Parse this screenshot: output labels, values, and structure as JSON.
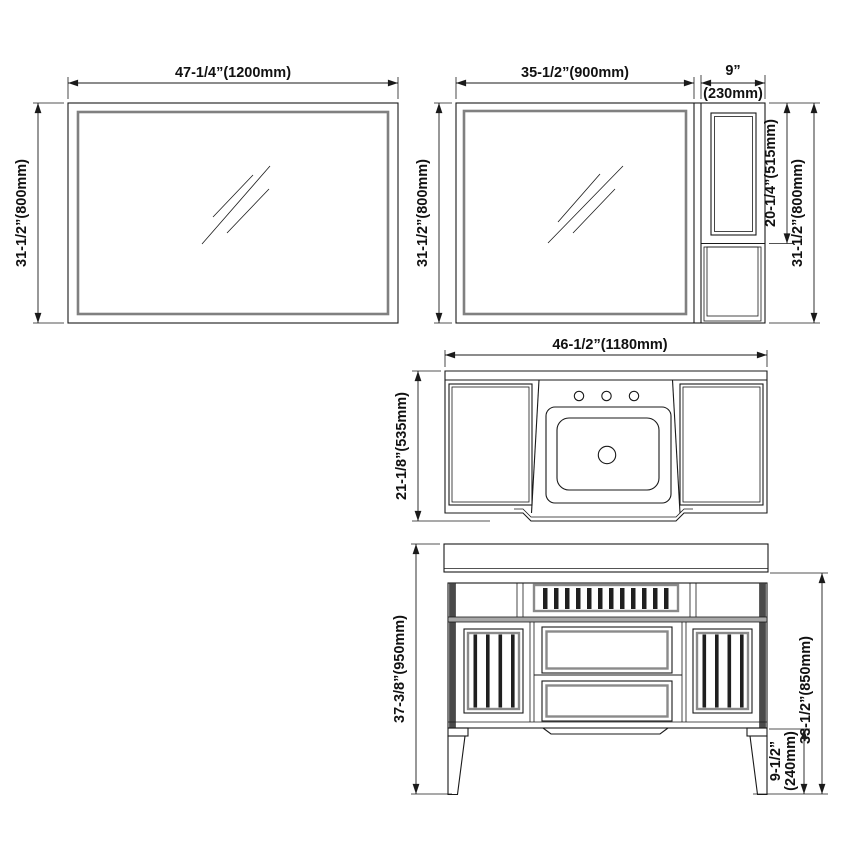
{
  "drawing": {
    "title": "bathroom-vanity-dimension-drawing",
    "colors": {
      "line": "#1a1a1a",
      "mirror_frame_gray": "#808080",
      "stile_dark": "#4a4a4a",
      "rail_gray": "#a8a8a8",
      "background": "#ffffff"
    },
    "mirror_large": {
      "width_label": "47-1/4”(1200mm)",
      "height_label": "31-1/2”(800mm)"
    },
    "mirror_cabinet": {
      "mirror_width_label": "35-1/2”(900mm)",
      "side_width_label_in": "9”",
      "side_width_label_mm": "(230mm)",
      "height_label_left": "31-1/2”(800mm)",
      "door_height_label": "20-1/4”(515mm)",
      "height_label_right": "31-1/2”(800mm)"
    },
    "countertop": {
      "width_label": "46-1/2”(1180mm)",
      "depth_label": "21-1/8”(535mm)"
    },
    "vanity": {
      "total_height_label": "37-3/8”(950mm)",
      "body_height_label": "33-1/2”(850mm)",
      "leg_height_label_in": "9-1/2”",
      "leg_height_label_mm": "(240mm)"
    }
  }
}
